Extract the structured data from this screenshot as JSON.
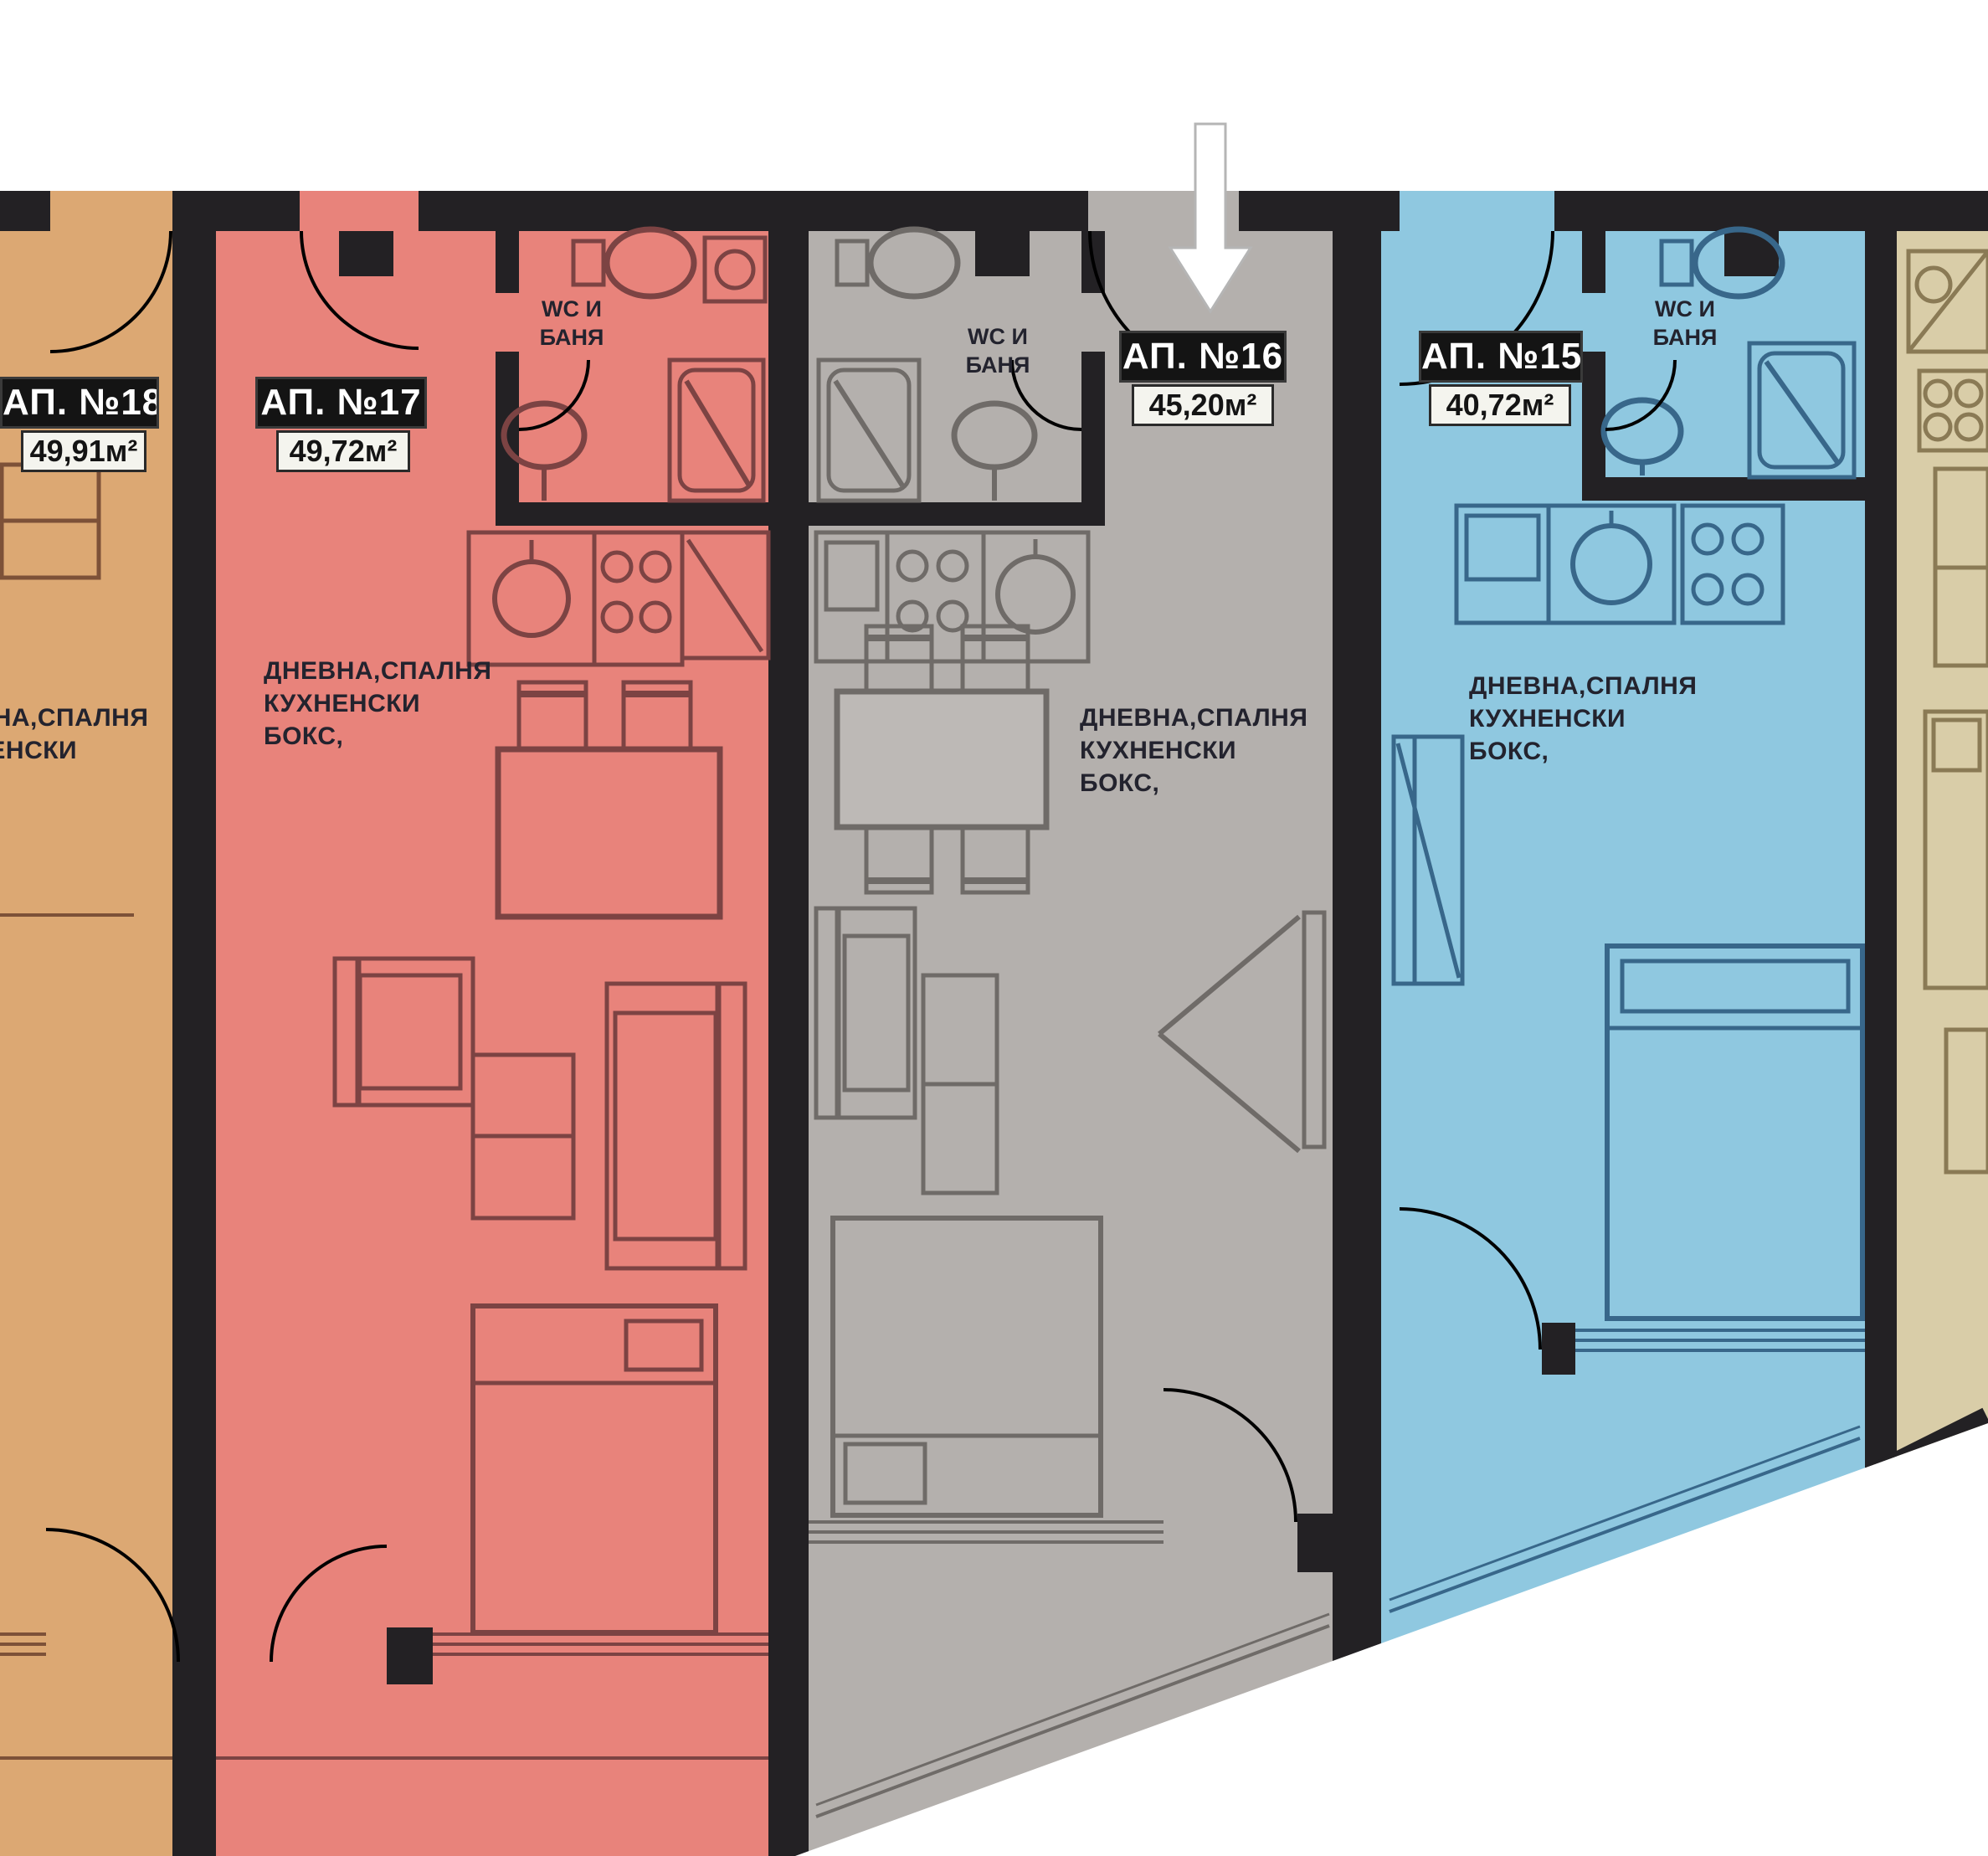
{
  "plan": {
    "type": "apartment-floor-plan",
    "wall_color": "#232124",
    "background": "#ffffff",
    "labels": {
      "wc_lines": [
        "WC И",
        "БАНЯ"
      ],
      "room_lines": [
        "ДНЕВНА,СПАЛНЯ",
        "КУХНЕНСКИ",
        "БОКС,"
      ]
    },
    "arrow": {
      "meaning": "selected-apartment",
      "color": "#ffffff"
    },
    "apartments": [
      {
        "id": "18",
        "name": "АП. №18",
        "area": "49,91м²",
        "fill": "#dca873"
      },
      {
        "id": "17",
        "name": "АП. №17",
        "area": "49,72м²",
        "fill": "#e8837b"
      },
      {
        "id": "16",
        "name": "АП. №16",
        "area": "45,20м²",
        "fill": "#b4b0ad",
        "highlighted": true
      },
      {
        "id": "15",
        "name": "АП. №15",
        "area": "40,72м²",
        "fill": "#8fc8e0"
      },
      {
        "id": "14",
        "fill": "#d9cda8"
      }
    ]
  }
}
